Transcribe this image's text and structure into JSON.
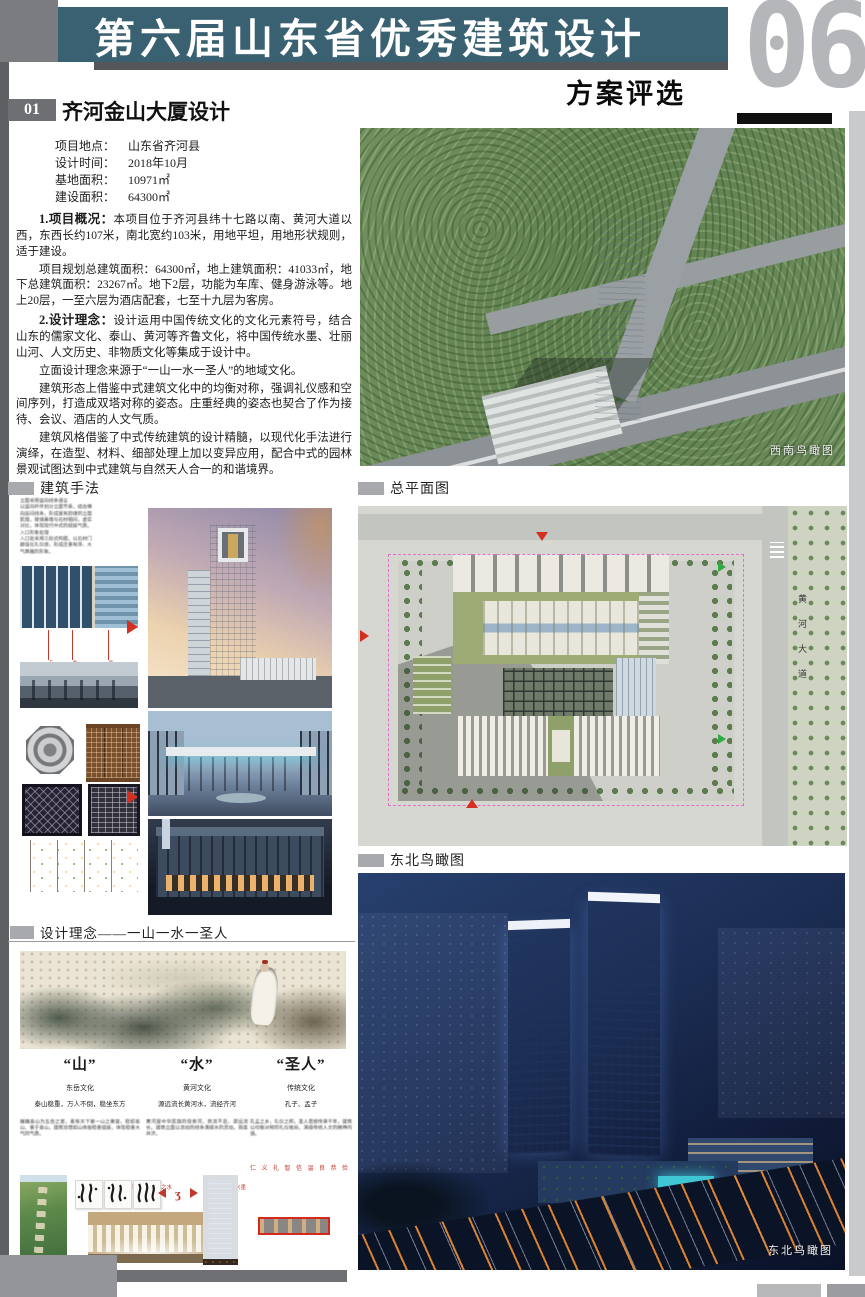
{
  "colors": {
    "banner_teal": "#3a6172",
    "accent_red": "#c0392b",
    "marker_gray": "#a7a9ac"
  },
  "header": {
    "banner_title": "第六届山东省优秀建筑设计",
    "subtitle": "方案评选",
    "page_number": "06",
    "project_no": "01",
    "project_title": "齐河金山大厦设计"
  },
  "info": {
    "rows": [
      {
        "label": "项目地点：",
        "value": "山东省齐河县"
      },
      {
        "label": "设计时间：",
        "value": "2018年10月"
      },
      {
        "label": "基地面积：",
        "value": "10971㎡"
      },
      {
        "label": "建设面积：",
        "value": "64300㎡"
      }
    ]
  },
  "overview": {
    "p1_lead": "1.项目概况：",
    "p1": "本项目位于齐河县纬十七路以南、黄河大道以西，东西长约107米，南北宽约103米，用地平坦，用地形状规则，适于建设。",
    "p2": "项目规划总建筑面积：64300㎡，地上建筑面积：41033㎡，地下总建筑面积：23267㎡。地下2层，功能为车库、健身游泳等。地上20层，一至六层为酒店配套，七至十九层为客房。",
    "p3_lead": "2.设计理念：",
    "p3": "设计运用中国传统文化的文化元素符号，结合山东的儒家文化、泰山、黄河等齐鲁文化，将中国传统水墨、壮丽山河、人文历史、非物质文化等集成于设计中。",
    "p4": "立面设计理念来源于“一山一水一圣人”的地域文化。",
    "p5": "建筑形态上借鉴中式建筑文化中的均衡对称，强调礼仪感和空间序列，打造成双塔对称的姿态。庄重经典的姿态也契合了作为接待、会议、酒店的人文气质。",
    "p6": "建筑风格借鉴了中式传统建筑的设计精髓，以现代化手法进行演绎，在造型、材料、细部处理上加以变异应用，配合中式的园林景观试图达到中式建筑与自然天人合一的和谐境界。"
  },
  "sections": {
    "methods": "建筑手法",
    "siteplan": "总平面图",
    "ne_view": "东北鸟瞰图",
    "concept": "设计理念——一山一水一圣人"
  },
  "captions": {
    "sw_aerial": "西南鸟瞰图",
    "ne_aerial": "东北鸟瞰图"
  },
  "methods": {
    "note": "立面采用竖向线条语言\n以竖向杆件划分立面节奏，结合横\n向层间线条，形成富有韵律的立面\n肌理，玻璃幕墙与石材相间，虚实\n对比，体现现代中式的挺拔气质。\n入口形象处理\n入口处采用三段式构图，以石材门\n廊强化礼仪感，形成庄重有序、大\n气典雅的形象。",
    "annots": [
      "石材竖线",
      "金属线条",
      "玻璃幕墙"
    ]
  },
  "siteplan": {
    "road_label": "黄河大道"
  },
  "concept": {
    "columns": [
      {
        "title": "“山”",
        "sub": "东岳文化",
        "line": "泰山稳重，万人不倒，稳坐东方",
        "para": "巍巍泰山为五岳之首，素有天下第一山之美誉。稳如泰山、重于泰山，建筑双塔如山体般稳重挺拔，体现稳重大气的气质。",
        "note": "泰山石刻"
      },
      {
        "title": "“水”",
        "sub": "黄河文化",
        "line": "源远流长黄河水，流经齐河",
        "para": "黄河是中华民族的母亲河，奔流不息、源远流长。建筑立面以流动的线条演绎水的灵动，刚柔并济。",
        "note": "黄河之水",
        "note2": "水墨"
      },
      {
        "title": "“圣人”",
        "sub": "传统文化",
        "line": "孔子、孟子",
        "para": "孔孟之乡，礼仪之邦。圣人思想传承千年，建筑以均衡对称的礼仪格局，演绎传统人文的精神内涵。",
        "virtues": "仁 义 礼 智 信 温 良 恭 俭"
      }
    ]
  }
}
